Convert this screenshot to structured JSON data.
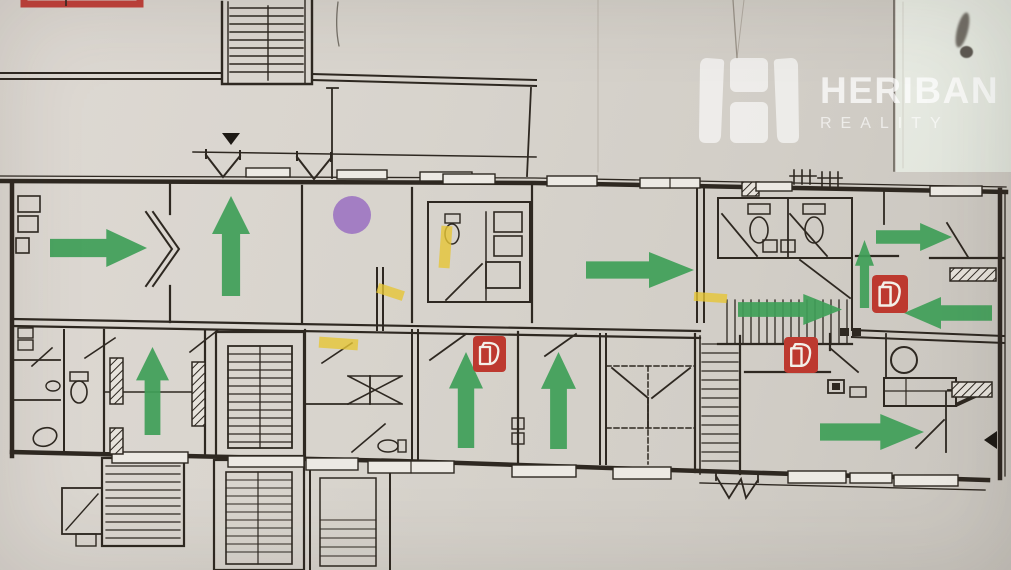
{
  "brand": {
    "name": "HERIBAN",
    "tagline": "REALITY"
  },
  "palette": {
    "paper": "#d8d4cd",
    "ink": "#2e2821",
    "arrow_green": "#3f9f58",
    "extinguisher_red": "#bd392f",
    "extinguisher_glyph": "#f3efe8",
    "marker_purple": "#9b72c1",
    "highlight_yellow": "#e6c636",
    "legend_red": "#c2403a",
    "triangle_black": "#1d1914"
  },
  "annotations": {
    "escape_arrows": [
      {
        "id": "arrow-left-room-right",
        "dir": "right",
        "x": 50,
        "y": 229,
        "w": 97,
        "h": 38
      },
      {
        "id": "arrow-left-room-up",
        "dir": "up",
        "x": 212,
        "y": 196,
        "w": 38,
        "h": 100
      },
      {
        "id": "arrow-center-hall-right",
        "dir": "right",
        "x": 586,
        "y": 252,
        "w": 108,
        "h": 36
      },
      {
        "id": "arrow-top-right-right",
        "dir": "right",
        "x": 876,
        "y": 223,
        "w": 76,
        "h": 28
      },
      {
        "id": "arrow-stairs-right",
        "dir": "right",
        "x": 738,
        "y": 294,
        "w": 104,
        "h": 31
      },
      {
        "id": "arrow-right-corridor-up",
        "dir": "up",
        "x": 855,
        "y": 240,
        "w": 19,
        "h": 68
      },
      {
        "id": "arrow-right-room-left",
        "dir": "left",
        "x": 904,
        "y": 297,
        "w": 88,
        "h": 32
      },
      {
        "id": "arrow-bottom-left-up",
        "dir": "up",
        "x": 136,
        "y": 347,
        "w": 33,
        "h": 88
      },
      {
        "id": "arrow-bottom-mid-up-1",
        "dir": "up",
        "x": 449,
        "y": 352,
        "w": 34,
        "h": 96
      },
      {
        "id": "arrow-bottom-mid-up-2",
        "dir": "up",
        "x": 541,
        "y": 352,
        "w": 35,
        "h": 97
      },
      {
        "id": "arrow-bottom-right-right",
        "dir": "right",
        "x": 820,
        "y": 414,
        "w": 104,
        "h": 36
      }
    ],
    "extinguishers": [
      {
        "id": "extinguisher-center",
        "x": 473,
        "y": 336,
        "w": 33,
        "h": 36
      },
      {
        "id": "extinguisher-bottom-right",
        "x": 784,
        "y": 337,
        "w": 34,
        "h": 36
      },
      {
        "id": "extinguisher-right-corridor",
        "x": 872,
        "y": 275,
        "w": 36,
        "h": 38
      }
    ],
    "assembly_marker": {
      "cx": 352,
      "cy": 215,
      "r": 19
    },
    "highlights": [
      {
        "x": 440,
        "y": 226,
        "w": 11,
        "h": 42,
        "rot": 4
      },
      {
        "x": 377,
        "y": 287,
        "w": 27,
        "h": 10,
        "rot": 18
      },
      {
        "x": 694,
        "y": 293,
        "w": 33,
        "h": 9,
        "rot": 4
      },
      {
        "x": 319,
        "y": 338,
        "w": 39,
        "h": 11,
        "rot": 4
      }
    ],
    "direction_triangles": [
      {
        "id": "triangle-down-top",
        "points": "222,133 240,133 231,145"
      },
      {
        "id": "triangle-left-right-edge",
        "points": "997,431 997,449 984,440"
      }
    ],
    "legend_box": {
      "x": 24,
      "y": -46,
      "w": 116,
      "h": 50
    }
  }
}
